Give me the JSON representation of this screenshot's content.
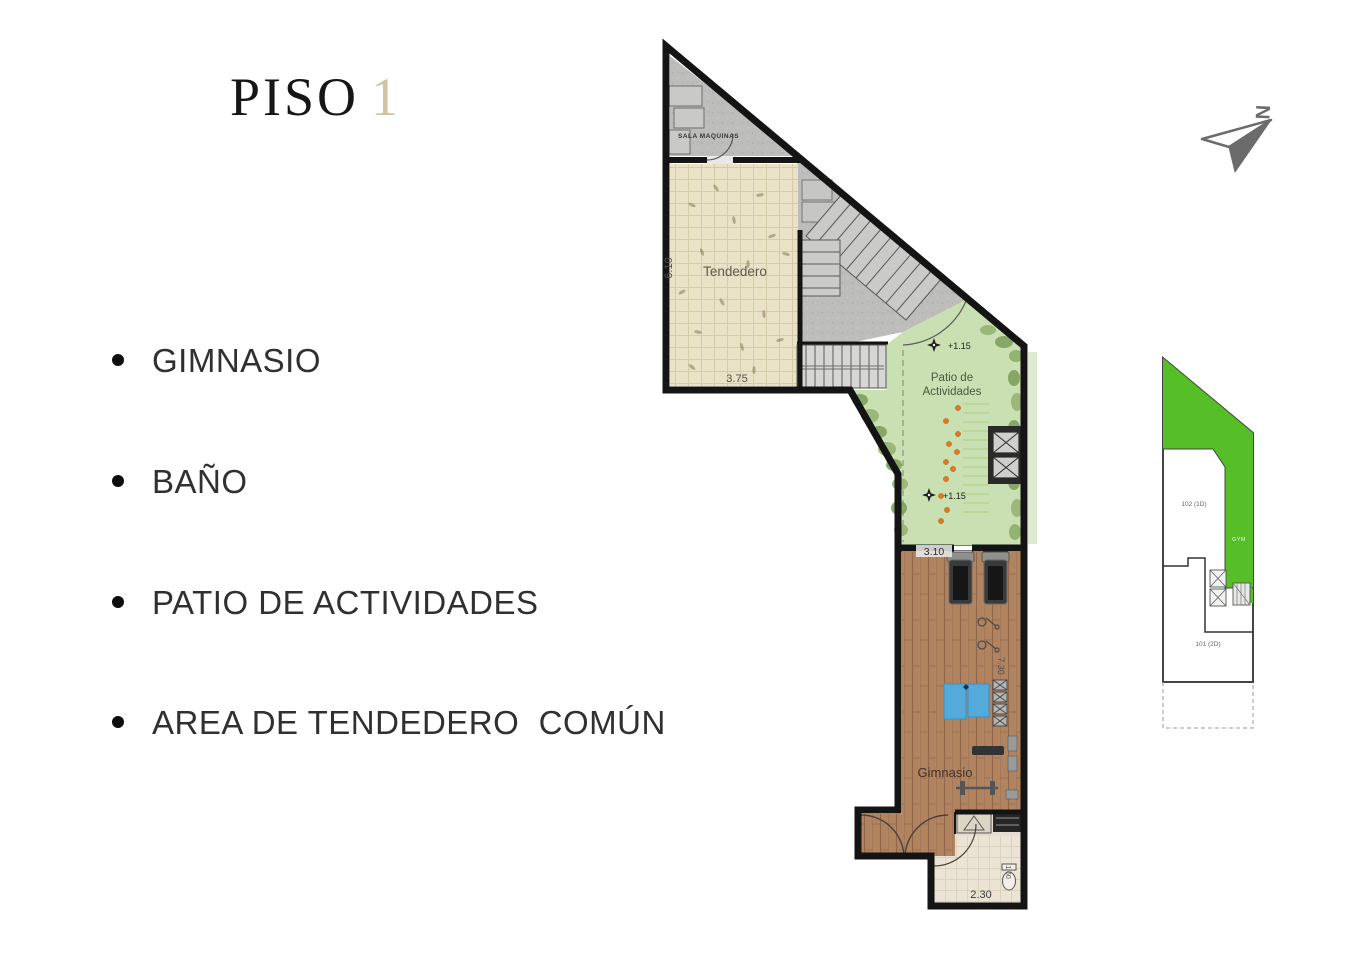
{
  "title": {
    "word": "PISO",
    "number": "1"
  },
  "features": [
    {
      "label": "GIMNASIO"
    },
    {
      "label": "BAÑO"
    },
    {
      "label": "PATIO DE ACTIVIDADES"
    },
    {
      "label": "AREA DE TENDEDERO  COMÚN"
    }
  ],
  "north": {
    "label": "N"
  },
  "plan": {
    "labels": {
      "sala_maquinas": "SALA  MAQUINAS",
      "tendedero": "Tendedero",
      "patio_line1": "Patio de",
      "patio_line2": "Actividades",
      "gimnasio": "Gimnasio"
    },
    "dims": {
      "tendedero_height": "6.10",
      "tendedero_width": "3.75",
      "gym_top_width": "3.10",
      "gym_height": "7.30",
      "bano_width": "2.30",
      "bano_height": "1.60"
    },
    "levels": {
      "upper": "+1.15",
      "lower": "+1.15"
    }
  },
  "keyplan": {
    "unit_top_label": "102 (1D)",
    "gym_label": "GYM",
    "unit_bottom_label": "101 (2D)"
  },
  "colors": {
    "title_accent": "#cfc5a3",
    "text": "#303030",
    "wall": "#141414",
    "tendedero_floor": "#eae2c6",
    "patio_green": "#c9e0b2",
    "wood": "#b1845f",
    "concrete": "#bdbdbb",
    "keyplan_green": "#56bf27",
    "mat_blue": "#55aadc",
    "planting_orange": "#e0781e",
    "north_gray": "#6b6b6b"
  }
}
